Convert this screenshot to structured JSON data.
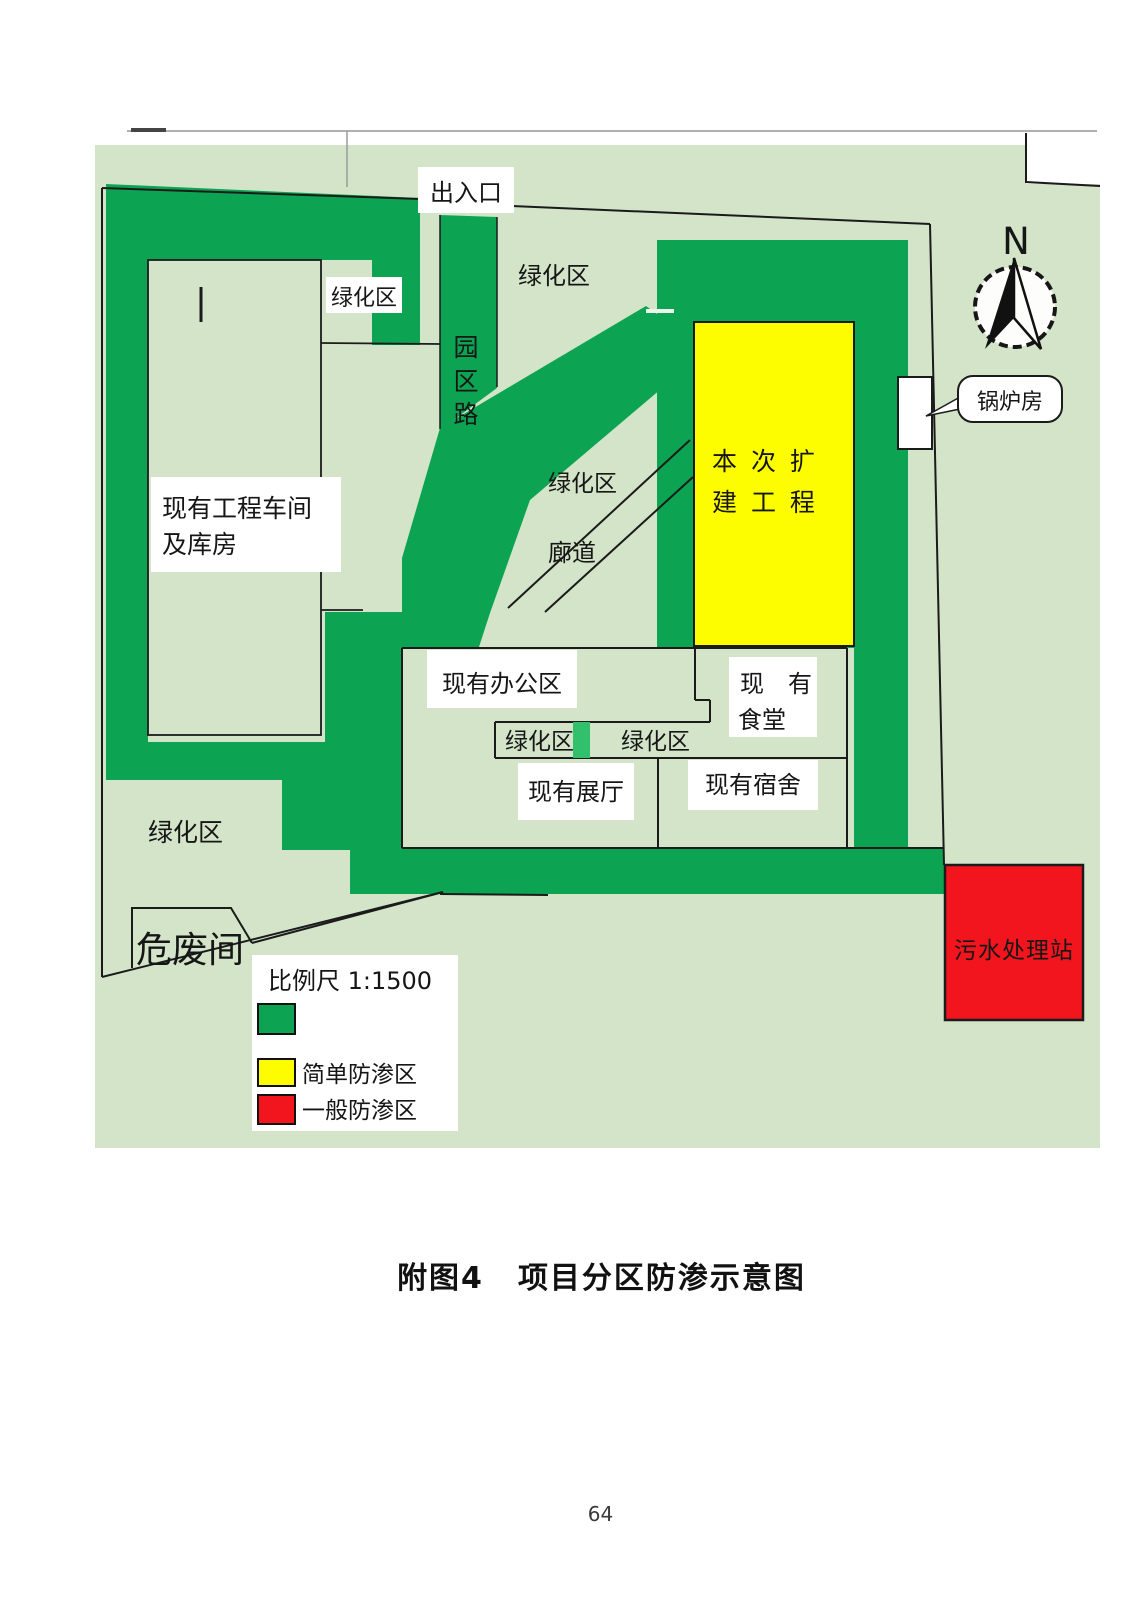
{
  "figure": {
    "caption_prefix": "附图4",
    "caption_title": "项目分区防渗示意图",
    "page_number": "64"
  },
  "map": {
    "labels": {
      "entrance": "出入口",
      "green_area": "绿化区",
      "park_road_chars": [
        "园",
        "区",
        "路"
      ],
      "corridor": "廊道",
      "workshop_line1": "现有工程车间",
      "workshop_line2": "及库房",
      "expansion_line1": "本 次 扩",
      "expansion_line2": "建 工 程",
      "office": "现有办公区",
      "canteen_line1": "现　有",
      "canteen_line2": "食堂",
      "exhibition": "现有展厅",
      "dormitory": "现有宿舍",
      "boiler": "锅炉房",
      "hazardous_waste": "危废间",
      "sewage_station": "污水处理站",
      "compass_north": "N"
    },
    "legend": {
      "scale_text": "比例尺  1:1500",
      "items": [
        {
          "swatch_color": "#0ca452",
          "label": ""
        },
        {
          "swatch_color": "#fdfd00",
          "label": "简单防渗区"
        },
        {
          "swatch_color": "#f2151d",
          "label": "一般防渗区"
        }
      ]
    },
    "colors": {
      "road_green": "#0ca452",
      "background_green": "#d3e4c9",
      "strip_square_green": "#33c06c",
      "expansion_yellow": "#fdfd00",
      "sewage_red": "#f2151d"
    }
  }
}
